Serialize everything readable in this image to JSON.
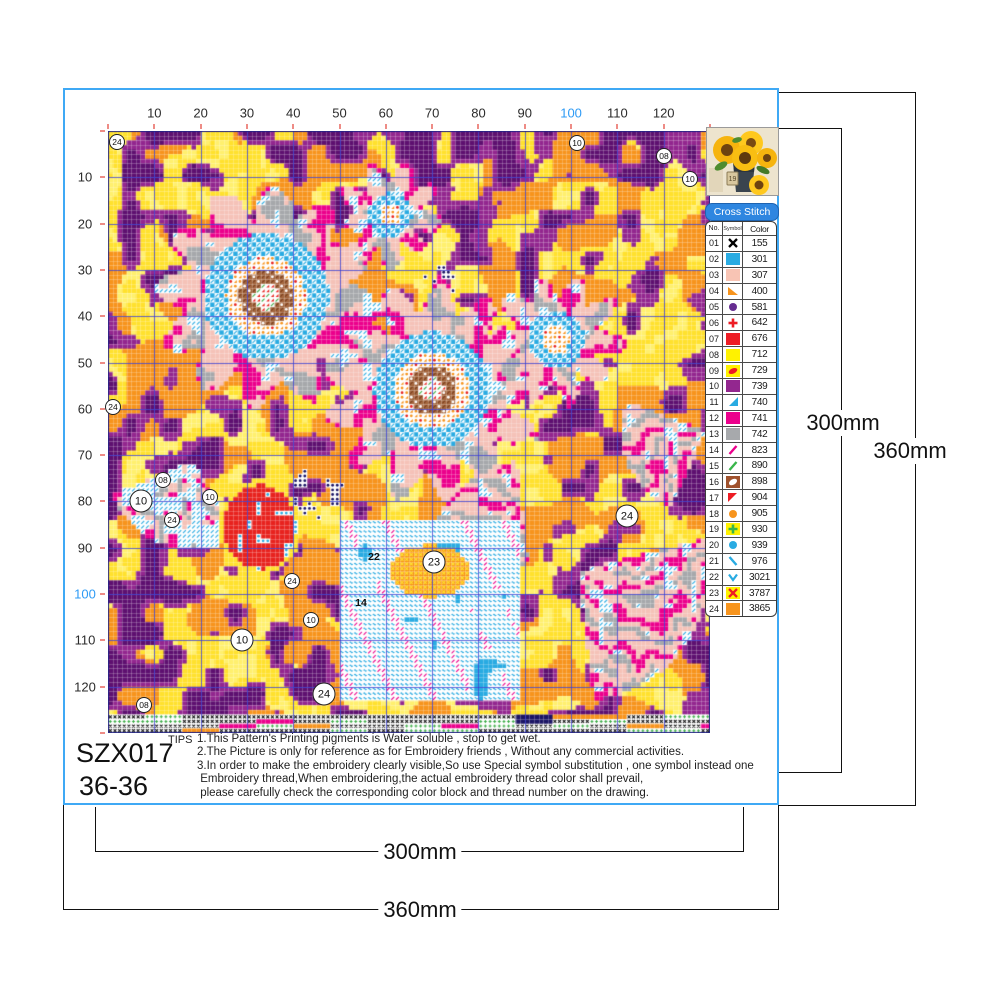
{
  "meta": {
    "product_code": "SZX017",
    "size_label": "36-36"
  },
  "frame": {
    "border_color": "#3FA9F5"
  },
  "ruler": {
    "labels": [
      10,
      20,
      30,
      40,
      50,
      60,
      70,
      80,
      90,
      100,
      110,
      120
    ],
    "highlight": 100,
    "label_color": "#2b2b2b",
    "highlight_color": "#2E9BF5",
    "tick_color": "#EE8C86"
  },
  "legend": {
    "title": "Cross Stitch",
    "columns": {
      "no": "No.",
      "symbol": "Symbol",
      "color": "Color"
    },
    "entries": [
      {
        "no": "01",
        "code": "155",
        "symbol": {
          "t": "x",
          "fg": "#000000",
          "bg": "#ffffff"
        }
      },
      {
        "no": "02",
        "code": "301",
        "symbol": {
          "t": "solid",
          "fg": "",
          "bg": "#29ABE2"
        }
      },
      {
        "no": "03",
        "code": "307",
        "symbol": {
          "t": "solid",
          "fg": "",
          "bg": "#F8C4B4"
        }
      },
      {
        "no": "04",
        "code": "400",
        "symbol": {
          "t": "tribl",
          "fg": "#F7941D",
          "bg": "#ffffff"
        }
      },
      {
        "no": "05",
        "code": "581",
        "symbol": {
          "t": "circle",
          "fg": "#662D91",
          "bg": "#ffffff"
        }
      },
      {
        "no": "06",
        "code": "642",
        "symbol": {
          "t": "plus",
          "fg": "#ED1C24",
          "bg": "#ffffff"
        }
      },
      {
        "no": "07",
        "code": "676",
        "symbol": {
          "t": "solid",
          "fg": "",
          "bg": "#ED1C24"
        }
      },
      {
        "no": "08",
        "code": "712",
        "symbol": {
          "t": "solid",
          "fg": "",
          "bg": "#FFF200"
        }
      },
      {
        "no": "09",
        "code": "729",
        "symbol": {
          "t": "blob",
          "fg": "#ED1C24",
          "bg": "#FFF200"
        }
      },
      {
        "no": "10",
        "code": "739",
        "symbol": {
          "t": "solid",
          "fg": "",
          "bg": "#93278F"
        }
      },
      {
        "no": "11",
        "code": "740",
        "symbol": {
          "t": "tribr",
          "fg": "#29ABE2",
          "bg": "#ffffff"
        }
      },
      {
        "no": "12",
        "code": "741",
        "symbol": {
          "t": "solid",
          "fg": "",
          "bg": "#EC008C"
        }
      },
      {
        "no": "13",
        "code": "742",
        "symbol": {
          "t": "solid",
          "fg": "",
          "bg": "#A7A9AC"
        }
      },
      {
        "no": "14",
        "code": "823",
        "symbol": {
          "t": "slash",
          "fg": "#EC008C",
          "bg": "#ffffff"
        }
      },
      {
        "no": "15",
        "code": "890",
        "symbol": {
          "t": "slash",
          "fg": "#39B54A",
          "bg": "#ffffff"
        }
      },
      {
        "no": "16",
        "code": "898",
        "symbol": {
          "t": "leaf",
          "fg": "#ffffff",
          "bg": "#A0522D"
        }
      },
      {
        "no": "17",
        "code": "904",
        "symbol": {
          "t": "tritl",
          "fg": "#ED1C24",
          "bg": "#ffffff"
        }
      },
      {
        "no": "18",
        "code": "905",
        "symbol": {
          "t": "circle",
          "fg": "#F7941D",
          "bg": "#ffffff"
        }
      },
      {
        "no": "19",
        "code": "930",
        "symbol": {
          "t": "plus",
          "fg": "#39B54A",
          "bg": "#FFF200"
        }
      },
      {
        "no": "20",
        "code": "939",
        "symbol": {
          "t": "circle",
          "fg": "#29ABE2",
          "bg": "#ffffff"
        }
      },
      {
        "no": "21",
        "code": "976",
        "symbol": {
          "t": "backslash",
          "fg": "#29ABE2",
          "bg": "#ffffff"
        }
      },
      {
        "no": "22",
        "code": "3021",
        "symbol": {
          "t": "chevron",
          "fg": "#29ABE2",
          "bg": "#ffffff"
        }
      },
      {
        "no": "23",
        "code": "3787",
        "symbol": {
          "t": "x",
          "fg": "#ED1C24",
          "bg": "#FFF200"
        }
      },
      {
        "no": "24",
        "code": "3865",
        "symbol": {
          "t": "solid",
          "fg": "",
          "bg": "#F7941D"
        }
      }
    ]
  },
  "thumbnail": {
    "vase_text": "19"
  },
  "tips": {
    "label": "TIPS",
    "lines": [
      "1.This Pattern's Printing pigments is Water soluble , stop to get wet.",
      "2.The Picture is only for reference as for Embroidery friends , Without any commercial activities.",
      "3.In order to make the embroidery clearly visible,So use Special symbol substitution , one symbol instead one",
      " Embroidery thread,When embroidering,the actual embroidery thread color shall prevail,",
      " please carefully check the corresponding color block and thread number on the drawing."
    ]
  },
  "dimensions": {
    "bottom_inner": "300mm",
    "bottom_outer": "360mm",
    "right_inner": "300mm",
    "right_outer": "360mm"
  },
  "pattern": {
    "seed": 77,
    "grid": {
      "cols": 130,
      "rows": 130,
      "cell": 4.6308
    },
    "palette": {
      "yellow": "#FFE12E",
      "yellow2": "#FFF06E",
      "orange": "#F7941D",
      "purple": "#93278F",
      "purple2": "#5E1070",
      "pink": "#F5C2B8",
      "gray": "#A6A8AB",
      "magenta": "#EC008C",
      "cyan": "#29ABE2",
      "red": "#E8231F",
      "green": "#3FAE49",
      "brown": "#A5673F",
      "navy": "#1B1464",
      "white": "#FFFFFF",
      "grid_major": "rgba(58,62,209,0.8)",
      "grid_minor": "rgba(255,255,255,0.22)"
    },
    "flowers": [
      {
        "cx": 158,
        "cy": 166,
        "core": 13,
        "brown": 27,
        "dots": 40,
        "ring": 63,
        "petal": 115,
        "petalN": 12,
        "ph": 0.5
      },
      {
        "cx": 324,
        "cy": 259,
        "core": 12,
        "brown": 25,
        "dots": 37,
        "ring": 58,
        "petal": 112,
        "petalN": 13,
        "ph": 2.1
      },
      {
        "cx": 448,
        "cy": 209,
        "core": 0,
        "brown": 0,
        "dots": 14,
        "ring": 28,
        "petal": 66,
        "petalN": 10,
        "ph": 1.0
      },
      {
        "cx": 282,
        "cy": 84,
        "core": 0,
        "brown": 0,
        "dots": 11,
        "ring": 22,
        "petal": 52,
        "petalN": 9,
        "ph": 0.3
      }
    ],
    "fans": [
      {
        "cx": 85,
        "cy": 330,
        "r": 88,
        "a0": 1.05,
        "a1": 2.75,
        "cyan": true
      },
      {
        "cx": 470,
        "cy": 440,
        "r": 130,
        "a0": -0.25,
        "a1": 1.45,
        "cyan": false
      },
      {
        "cx": 598,
        "cy": 300,
        "r": 85,
        "a0": 2.0,
        "a1": 3.5,
        "cyan": false
      },
      {
        "cx": 420,
        "cy": 430,
        "r": 100,
        "a0": 2.6,
        "a1": 4.6,
        "cyan": false
      }
    ],
    "vase": {
      "x0": 232,
      "y0": 389,
      "x1": 414,
      "y1": 569,
      "ox": 322,
      "oy": 440,
      "orx": 40,
      "ory": 26
    },
    "bud": {
      "cx": 152,
      "cy": 396,
      "rx": 36,
      "ry": 42
    },
    "navy_blobs": [
      {
        "cx": 210,
        "cy": 362,
        "r": 26
      },
      {
        "cx": 330,
        "cy": 152,
        "r": 18
      },
      {
        "cx": 372,
        "cy": 300,
        "r": 20
      }
    ],
    "border_row": 126,
    "markers": [
      {
        "x": 9,
        "y": 11,
        "label": "24",
        "style": "small"
      },
      {
        "x": 469,
        "y": 12,
        "label": "10",
        "style": "small"
      },
      {
        "x": 556,
        "y": 25,
        "label": "08",
        "style": "small"
      },
      {
        "x": 582,
        "y": 48,
        "label": "10",
        "style": "small"
      },
      {
        "x": 5,
        "y": 276,
        "label": "24",
        "style": "small"
      },
      {
        "x": 33,
        "y": 370,
        "label": "10",
        "style": "big"
      },
      {
        "x": 55,
        "y": 349,
        "label": "08",
        "style": "small"
      },
      {
        "x": 64,
        "y": 389,
        "label": "24",
        "style": "small"
      },
      {
        "x": 102,
        "y": 366,
        "label": "10",
        "style": "small"
      },
      {
        "x": 134,
        "y": 509,
        "label": "10",
        "style": "big"
      },
      {
        "x": 184,
        "y": 450,
        "label": "24",
        "style": "small"
      },
      {
        "x": 203,
        "y": 489,
        "label": "10",
        "style": "small"
      },
      {
        "x": 216,
        "y": 563,
        "label": "24",
        "style": "big"
      },
      {
        "x": 36,
        "y": 574,
        "label": "08",
        "style": "small"
      },
      {
        "x": 519,
        "y": 385,
        "label": "24",
        "style": "big"
      },
      {
        "x": 326,
        "y": 431,
        "label": "23",
        "style": "big"
      },
      {
        "x": 266,
        "y": 426,
        "label": "22",
        "style": "plain"
      },
      {
        "x": 253,
        "y": 472,
        "label": "14",
        "style": "plain"
      }
    ]
  }
}
